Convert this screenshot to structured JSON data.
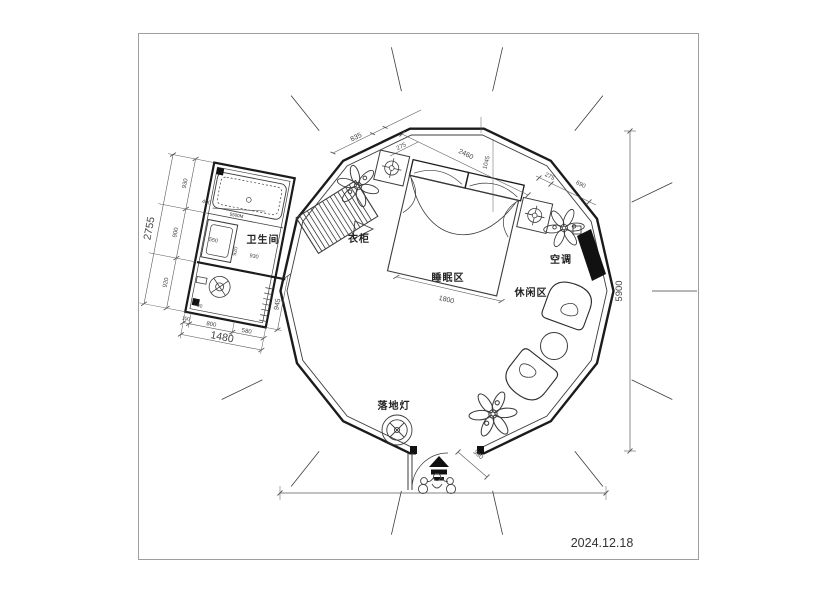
{
  "page": {
    "date": "2024.12.18"
  },
  "labels": {
    "bathroom": "卫生间",
    "wardrobe": "衣柜",
    "sleeping_area": "睡眠区",
    "leisure_area": "休闲区",
    "air_conditioner": "空调",
    "floor_lamp": "落地灯"
  },
  "dims": {
    "a835": "835",
    "a275": "275",
    "b2460": "2460",
    "b1045": "1045",
    "c275": "275",
    "c690": "690",
    "height": "5900",
    "bed": "1800",
    "entry": "360",
    "bl1": "930",
    "bl2": "900",
    "bl3": "920",
    "bl_total": "2755",
    "bb1": "100",
    "bb2": "800",
    "bb3": "580",
    "bb_total": "1480",
    "side": "945",
    "i550": "550",
    "i920": "920",
    "i930": "930",
    "i400": "400",
    "i90": "90",
    "note": "5500M"
  },
  "icons": {
    "plant": "plant-icon",
    "ceiling_lamp": "ceiling-lamp-icon",
    "floor_lamp": "floor-lamp-icon",
    "entry_arrow": "entry-arrow-icon",
    "people": "person-icon",
    "door_swing": "door-swing-icon"
  },
  "colors": {
    "wall": "#1b1b1b",
    "line": "#3c3c3c",
    "dim": "#5a5a5a",
    "frame": "#9e9e9e",
    "fill_dark": "#111111",
    "bg": "#ffffff"
  }
}
